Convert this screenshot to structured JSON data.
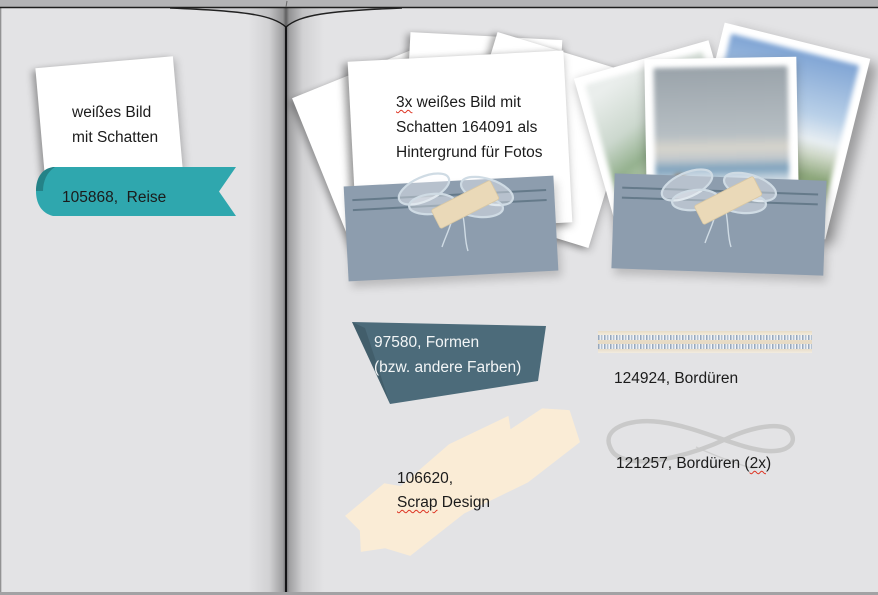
{
  "left_page": {
    "card": {
      "lines": [
        "weißes Bild",
        "mit Schatten"
      ]
    },
    "ribbon": {
      "label": "105868,  Reise"
    }
  },
  "right_page": {
    "stack": {
      "line1_misspell": "3x",
      "line1_rest": " weißes Bild mit",
      "line2": "Schatten 164091 als",
      "line3": "Hintergrund für Fotos"
    },
    "formen": {
      "line1": "97580, Formen",
      "line2": "(bzw. andere Farben)"
    },
    "border_strip": {
      "label": "124924, Bordüren"
    },
    "flourish": {
      "label_prefix": "121257, Bordüren (",
      "label_misspell": "2x",
      "label_suffix": ")"
    },
    "scrap": {
      "line1": "106620,",
      "line2_misspell": "Scrap",
      "line2_rest": " Design"
    }
  },
  "icons": {
    "ribbon_bow": "sketched-bow",
    "washi_tape": "tape-strip",
    "infinity_flourish": "infinity-swirl",
    "lace_border": "crochet-band"
  },
  "colors": {
    "teal": "#2fa7ae",
    "slate_ribbon": "#4c6b7a",
    "pocket_blue": "#8d9dae",
    "pocket_line": "#5e7484",
    "cream": "#faecd6",
    "tape": "#ead9b8",
    "page": "#e3e3e5",
    "outer_gray": "#b3b3b5",
    "flourish_gray": "#c9c9c9",
    "spellcheck_red": "#dd3322",
    "text": "#1b1b1b",
    "ribbon_text_white": "#f2f5f6"
  }
}
